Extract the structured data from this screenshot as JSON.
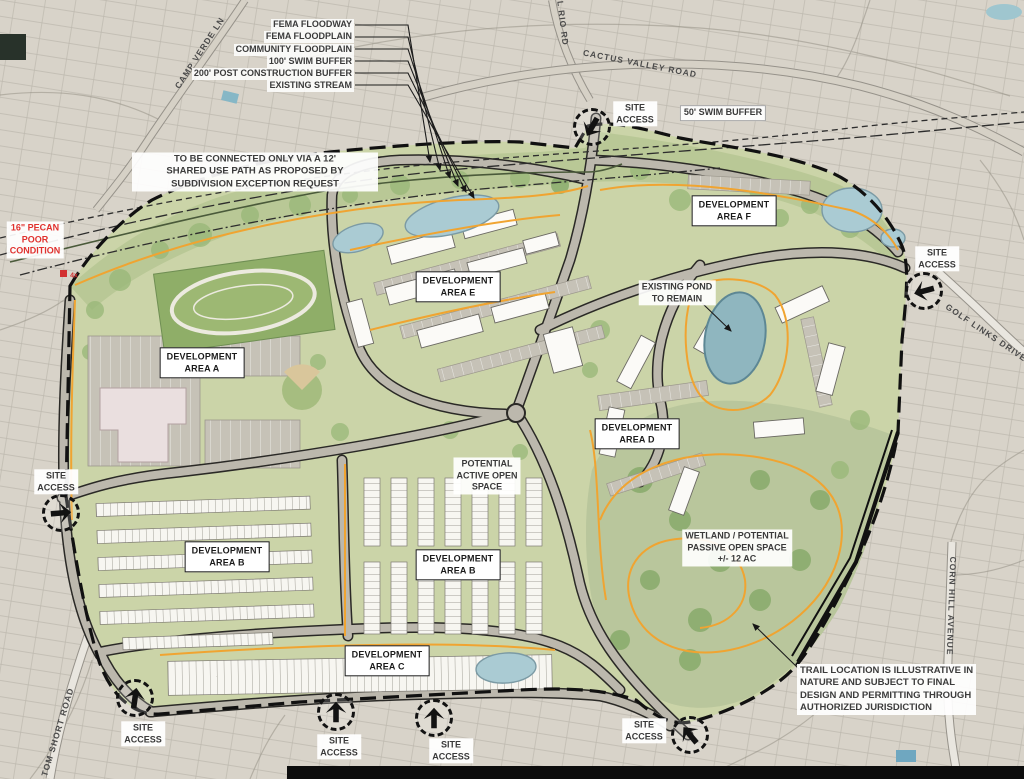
{
  "title": "Land Development Site Plan",
  "colors": {
    "site_green": "#cbd4a8",
    "corridor_green": "#b7c794",
    "pond_blue": "#a9cbd4",
    "existing_pond_teal": "#8fb6bf",
    "trail_orange": "#f0a431",
    "boundary_black": "#1a1a1a",
    "note_red": "#e0312e",
    "road_gray": "#bcb8ad"
  },
  "legend_callouts": [
    "FEMA FLOODWAY",
    "FEMA FLOODPLAIN",
    "COMMUNITY FLOODPLAIN",
    "100' SWIM BUFFER",
    "200' POST CONSTRUCTION BUFFER",
    "EXISTING STREAM"
  ],
  "roads": {
    "camp_verde": "CAMP VERDE LN",
    "el_rio": "EL RIO RD",
    "cactus_valley": "CACTUS VALLEY ROAD",
    "golf_links": "GOLF LINKS DRIVE",
    "corn_hill": "CORN HILL AVENUE",
    "tom_short": "TOM SHORT ROAD"
  },
  "areas": {
    "a": "DEVELOPMENT\nAREA A",
    "b": "DEVELOPMENT\nAREA B",
    "c": "DEVELOPMENT\nAREA C",
    "d": "DEVELOPMENT\nAREA D",
    "e": "DEVELOPMENT\nAREA E",
    "f": "DEVELOPMENT\nAREA F"
  },
  "site_access": "SITE\nACCESS",
  "notes": {
    "connection": "TO BE CONNECTED ONLY VIA A 12'\nSHARED USE PATH AS PROPOSED BY\nSUBDIVISION EXCEPTION REQUEST",
    "pecan": "16\" PECAN\nPOOR\nCONDITION",
    "pecan_marker": "4x",
    "swim_buffer_50": "50' SWIM BUFFER",
    "existing_pond": "EXISTING POND\nTO REMAIN",
    "active_open": "POTENTIAL\nACTIVE OPEN\nSPACE",
    "wetland": "WETLAND / POTENTIAL\nPASSIVE OPEN SPACE\n+/- 12 AC",
    "trail": "TRAIL LOCATION IS ILLUSTRATIVE IN\nNATURE AND SUBJECT TO FINAL\nDESIGN AND PERMITTING THROUGH\nAUTHORIZED JURISDICTION"
  }
}
